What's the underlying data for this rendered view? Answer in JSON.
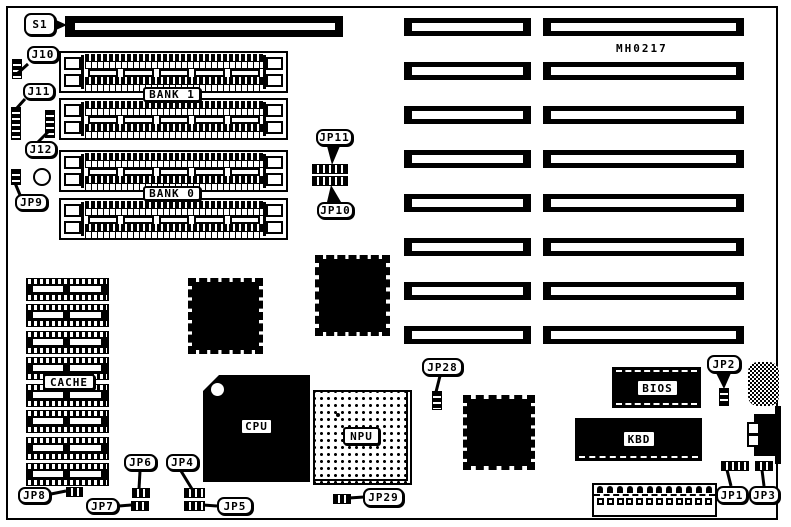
{
  "diagram": {
    "part_number": "MH0217",
    "colors": {
      "foreground": "#000000",
      "background": "#ffffff"
    },
    "labels": {
      "s1": "S1",
      "j10": "J10",
      "j11": "J11",
      "j12": "J12",
      "jp9": "JP9",
      "bank1": "BANK 1",
      "bank0": "BANK 0",
      "jp11": "JP11",
      "jp10": "JP10",
      "jp28": "JP28",
      "jp2": "JP2",
      "cache": "CACHE",
      "cpu": "CPU",
      "npu": "NPU",
      "bios": "BIOS",
      "kbd": "KBD",
      "jp8": "JP8",
      "jp7": "JP7",
      "jp6": "JP6",
      "jp4": "JP4",
      "jp5": "JP5",
      "jp29": "JP29",
      "jp1": "JP1",
      "jp3": "JP3"
    }
  }
}
